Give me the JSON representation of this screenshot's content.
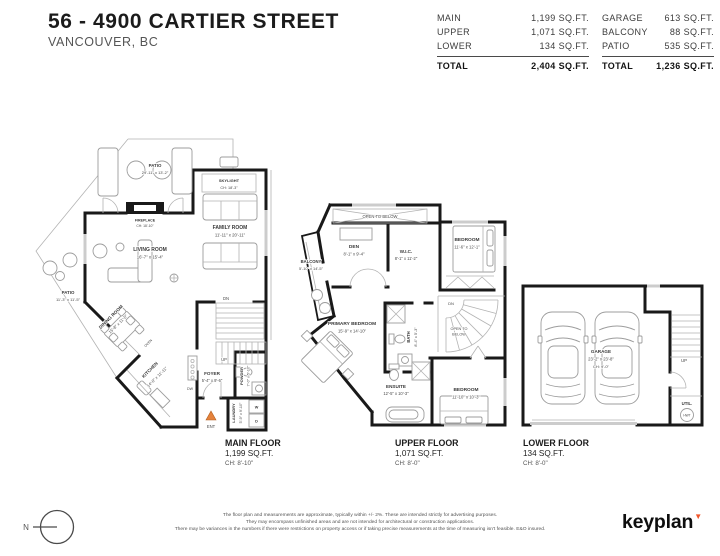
{
  "header": {
    "title": "56 - 4900 CARTIER STREET",
    "subtitle": "VANCOUVER, BC"
  },
  "area_table": {
    "left": {
      "rows": [
        {
          "label": "MAIN",
          "value": "1,199 SQ.FT."
        },
        {
          "label": "UPPER",
          "value": "1,071 SQ.FT."
        },
        {
          "label": "LOWER",
          "value": "134 SQ.FT."
        }
      ],
      "total_label": "TOTAL",
      "total_value": "2,404 SQ.FT."
    },
    "right": {
      "rows": [
        {
          "label": "GARAGE",
          "value": "613 SQ.FT."
        },
        {
          "label": "BALCONY",
          "value": "88 SQ.FT."
        },
        {
          "label": "PATIO",
          "value": "535 SQ.FT."
        }
      ],
      "total_label": "TOTAL",
      "total_value": "1,236 SQ.FT."
    }
  },
  "main_floor": {
    "patio_top": {
      "name": "PATIO",
      "dims": "29'-11\" x 13'-2\""
    },
    "skylight": {
      "name": "SKYLIGHT",
      "ch": "CH: 18'-3\""
    },
    "family": {
      "name": "FAMILY ROOM",
      "dims": "11'-11\" x 20'-11\""
    },
    "fireplace": {
      "name": "FIREPLACE",
      "ch": "CH: 18'-10\""
    },
    "living": {
      "name": "LIVING ROOM",
      "dims": "16'-7\" x 15'-4\""
    },
    "patio_left": {
      "name": "PATIO",
      "dims": "11'-3\" x 11'-5\""
    },
    "dining": {
      "name": "DINING ROOM",
      "dims": "15'-8\" x 11'-5\""
    },
    "kitchen": {
      "name": "KITCHEN",
      "dims": "14'-0\" x 11'-11\""
    },
    "foyer": {
      "name": "FOYER",
      "dims": "5'-4\" x 9'-6\""
    },
    "powder": {
      "name": "POWDER",
      "dims": "7'-0\" x 5'-10\""
    },
    "laundry": {
      "name": "LAUNDRY",
      "dims": "5'-9\" x 9'-10\""
    },
    "markers": {
      "dn": "DN",
      "up": "UP",
      "dw": "DW",
      "oven": "OVEN",
      "ent": "ENT",
      "washer": "W",
      "dryer": "D"
    },
    "label": {
      "title": "MAIN FLOOR",
      "area": "1,199 SQ.FT.",
      "ch": "CH: 8'-10\""
    }
  },
  "upper_floor": {
    "open_below_top": "OPEN TO BELOW",
    "balcony": {
      "name": "BALCONY",
      "dims": "5'-10\" x 14'-5\""
    },
    "den": {
      "name": "DEN",
      "dims": "8'-1\" x 9'-4\""
    },
    "wic": {
      "name": "W.I.C.",
      "dims": "8'-1\" x 11'-2\""
    },
    "bedroom_top": {
      "name": "BEDROOM",
      "dims": "11'-6\" x 12'-1\""
    },
    "primary": {
      "name": "PRIMARY BEDROOM",
      "dims": "15'-9\" x 14'-10\""
    },
    "bath": {
      "name": "BATH",
      "dims": "8'-4\" x 5'-3\""
    },
    "stair_open_1": "OPEN TO",
    "stair_open_2": "BELOW",
    "ensuite": {
      "name": "ENSUITE",
      "dims": "12'-5\" x 10'-3\""
    },
    "bedroom_bottom": {
      "name": "BEDROOM",
      "dims": "11'-10\" x 10'-3\""
    },
    "markers": {
      "dn": "DN"
    },
    "label": {
      "title": "UPPER FLOOR",
      "area": "1,071 SQ.FT.",
      "ch": "CH: 8'-0\""
    }
  },
  "lower_floor": {
    "garage": {
      "name": "GARAGE",
      "dims": "23'-2\" x 23'-8\"",
      "ch": "CH: 9'-0\""
    },
    "util_label": "UTIL.",
    "hwt_label": "HWT",
    "markers": {
      "up": "UP"
    },
    "label": {
      "title": "LOWER FLOOR",
      "area": "134 SQ.FT.",
      "ch": "CH: 8'-0\""
    }
  },
  "footer": {
    "compass_n": "N",
    "disclaimer": [
      "The floor plan and measurements are approximate, typically within +/- 2%. These are intended strictly for advertising purposes.",
      "They may encompass unfinished areas and are not intended for architectural or construction applications.",
      "There may be variances in the numbers if there were restrictions on property access or if taking precise measurements at the time of measuring isn't feasible. E&O insured."
    ],
    "logo": "keyplan"
  },
  "colors": {
    "wall": "#191919",
    "thin_line": "#b3b3b3",
    "accent_orange": "#e5823c",
    "logo_accent": "#f1562c"
  }
}
